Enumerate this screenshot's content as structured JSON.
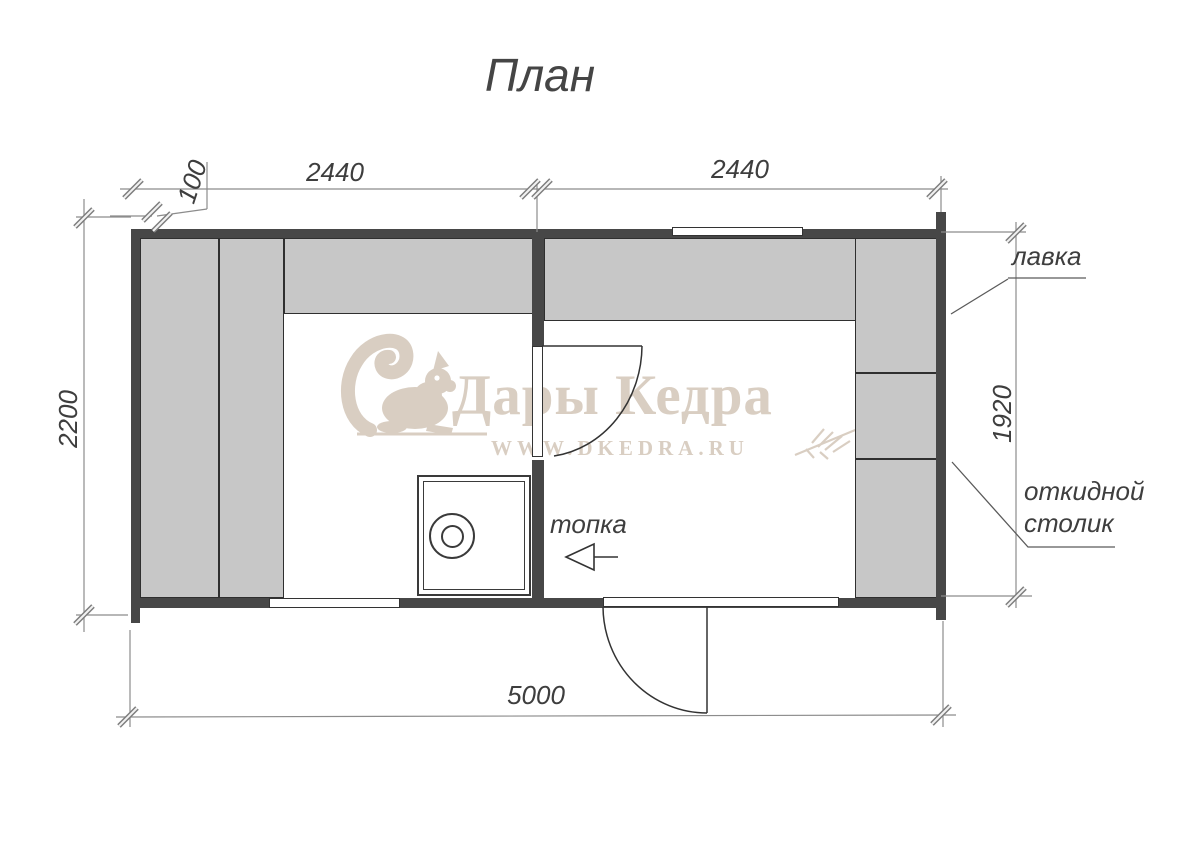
{
  "title": "План",
  "dimensions": {
    "offset_left": "100",
    "room_left_width": "2440",
    "room_right_width": "2440",
    "depth": "2200",
    "bench_length": "1920",
    "total_length": "5000"
  },
  "labels": {
    "bench": "лавка",
    "folding_table": "откидной столик",
    "firebox": "топка"
  },
  "watermark": {
    "brand": "Дары Кедра",
    "site": "WWW.DKEDRA.RU"
  },
  "colors": {
    "wall": "#474747",
    "bench_fill": "#c7c7c7",
    "outline": "#333333",
    "dimension_line": "#8c8c8c",
    "text": "#3e3e3e",
    "watermark": "#d9cec2"
  }
}
